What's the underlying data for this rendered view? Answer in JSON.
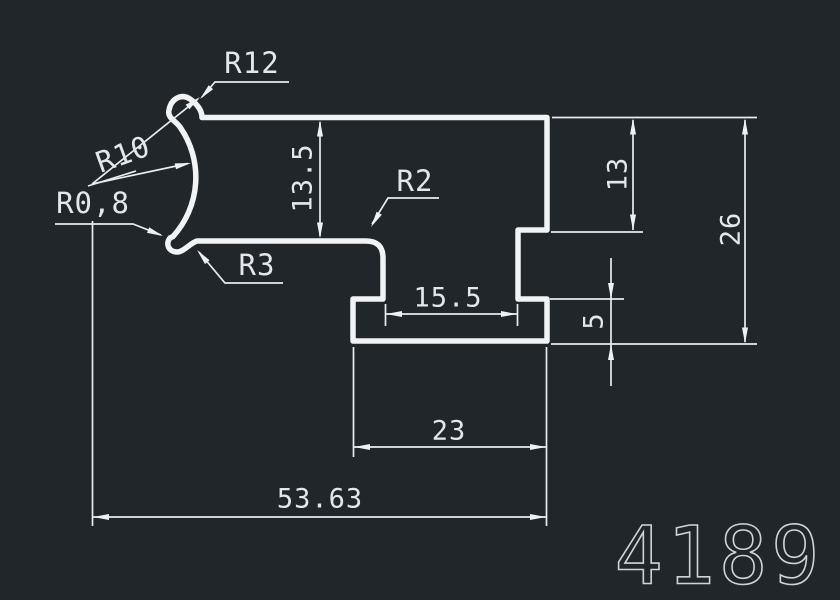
{
  "drawing": {
    "type": "cad-profile-cross-section",
    "part_number": "4189",
    "colors": {
      "background": "#21262b",
      "line": "#f1f3f5",
      "dimension_line": "#e9ecef",
      "text": "#e4e7ea",
      "part_number_text": "#cfd3d7"
    },
    "radius_labels": {
      "r12": "R12",
      "r10": "R10",
      "r0_8": "R0,8",
      "r3": "R3",
      "r2": "R2"
    },
    "dimensions": {
      "arm_thickness": "13.5",
      "right_upper_height": "13",
      "total_height": "26",
      "flange_thickness": "5",
      "slot_width": "15.5",
      "flange_width": "23",
      "total_width": "53.63"
    }
  }
}
